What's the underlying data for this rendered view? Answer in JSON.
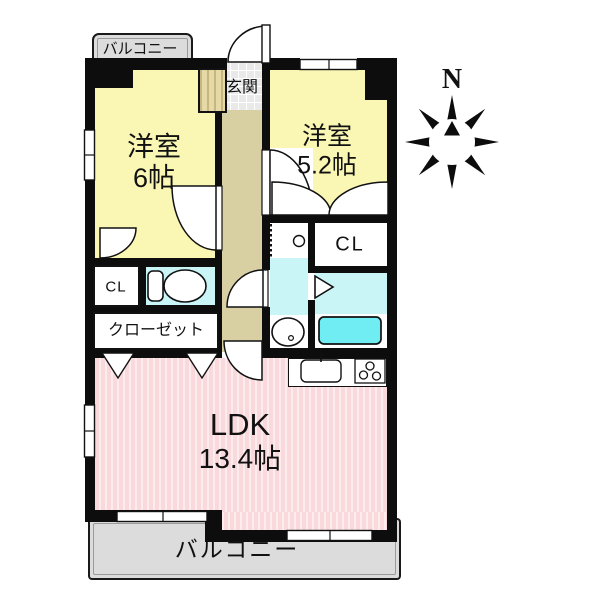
{
  "plan": {
    "balcony_top": "バルコニー",
    "balcony_bottom": "バルコニー",
    "entrance": "玄関",
    "room_west": {
      "name": "洋室",
      "size": "6帖"
    },
    "room_east": {
      "name": "洋室",
      "size": "5.2帖"
    },
    "closet_small_west": "CL",
    "closet_small_east": "CL",
    "closet_long": "クローゼット",
    "ldk": {
      "name": "LDK",
      "size": "13.4帖"
    },
    "compass": {
      "north_label": "N"
    },
    "colors": {
      "room_yellow": "#FAF7B5",
      "hall_tan": "#D8CFA3",
      "entrance_tile": "#E9E9E9",
      "wet_area_cyan": "#C9F5F7",
      "bathtub_cyan": "#6FEDF2",
      "ldk_pink": "#F9DADD",
      "balcony_gray": "#DCDCDC",
      "wall_black": "#0D0D0D"
    },
    "fixture_icons": [
      "toilet-icon",
      "washbasin-icon",
      "bathtub-icon",
      "kitchen-sink-icon",
      "stove-icon",
      "washer-space-icon",
      "compass-rose-icon"
    ]
  }
}
